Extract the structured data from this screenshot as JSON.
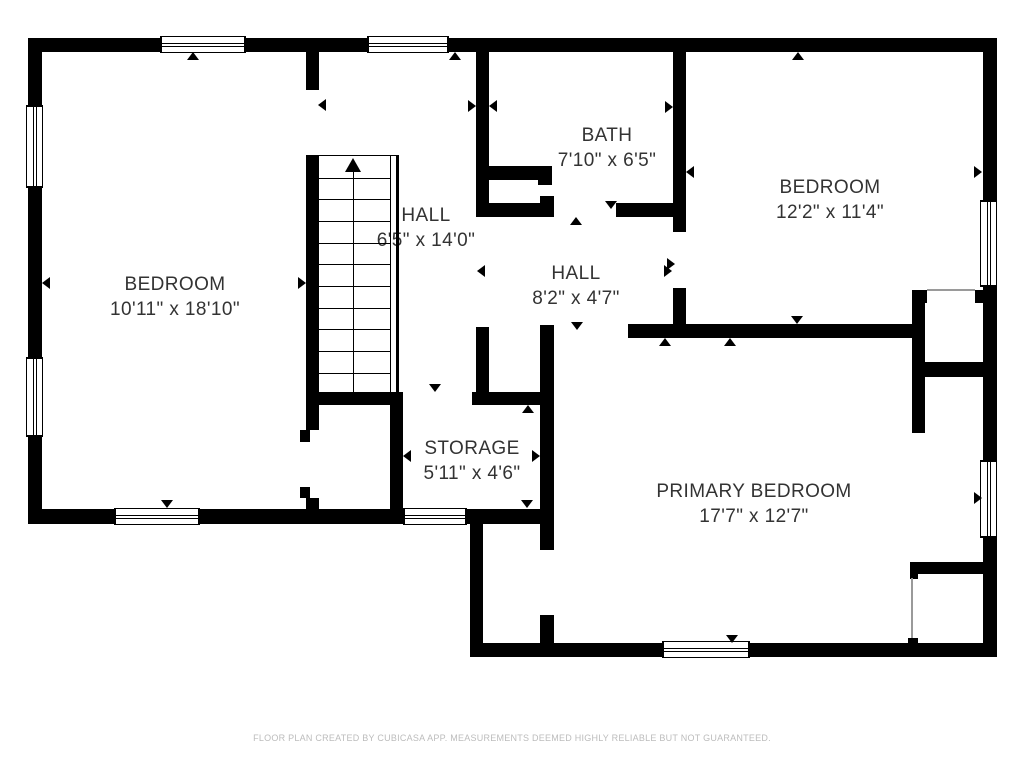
{
  "colors": {
    "wall": "#000000",
    "label_text": "#333333",
    "footer_text": "#bcbcbc",
    "background": "#ffffff"
  },
  "rooms": [
    {
      "id": "bedroom-left",
      "name": "BEDROOM",
      "dims": "10'11\" x 18'10\"",
      "cx": 175,
      "cy": 297
    },
    {
      "id": "hall-stairs",
      "name": "HALL",
      "dims": "6'5\" x 14'0\"",
      "cx": 426,
      "cy": 228
    },
    {
      "id": "bath",
      "name": "BATH",
      "dims": "7'10\" x 6'5\"",
      "cx": 607,
      "cy": 148
    },
    {
      "id": "bedroom-right",
      "name": "BEDROOM",
      "dims": "12'2\" x 11'4\"",
      "cx": 830,
      "cy": 200
    },
    {
      "id": "hall-small",
      "name": "HALL",
      "dims": "8'2\" x 4'7\"",
      "cx": 576,
      "cy": 286
    },
    {
      "id": "storage",
      "name": "STORAGE",
      "dims": "5'11\" x 4'6\"",
      "cx": 472,
      "cy": 461
    },
    {
      "id": "primary-bedroom",
      "name": "PRIMARY BEDROOM",
      "dims": "17'7\" x 12'7\"",
      "cx": 754,
      "cy": 504
    }
  ],
  "footer": {
    "text": "FLOOR PLAN CREATED BY CUBICASA APP. MEASUREMENTS DEEMED HIGHLY RELIABLE BUT NOT GUARANTEED."
  },
  "geometry": {
    "walls": [
      [
        28,
        38,
        969,
        14
      ],
      [
        28,
        38,
        14,
        486
      ],
      [
        28,
        509,
        519,
        15
      ],
      [
        470,
        509,
        13,
        148
      ],
      [
        470,
        643,
        527,
        14
      ],
      [
        983,
        38,
        14,
        619
      ],
      [
        306,
        52,
        13,
        38
      ],
      [
        306,
        155,
        13,
        275
      ],
      [
        300,
        430,
        10,
        12
      ],
      [
        300,
        487,
        10,
        11
      ],
      [
        306,
        498,
        13,
        13
      ],
      [
        306,
        392,
        96,
        13
      ],
      [
        390,
        392,
        13,
        119
      ],
      [
        476,
        52,
        13,
        165
      ],
      [
        489,
        166,
        63,
        14
      ],
      [
        538,
        166,
        14,
        19
      ],
      [
        476,
        203,
        78,
        14
      ],
      [
        540,
        196,
        14,
        21
      ],
      [
        616,
        203,
        70,
        14
      ],
      [
        673,
        52,
        13,
        180
      ],
      [
        673,
        288,
        13,
        48
      ],
      [
        628,
        324,
        292,
        14
      ],
      [
        476,
        327,
        13,
        78
      ],
      [
        472,
        392,
        81,
        13
      ],
      [
        540,
        325,
        14,
        225
      ],
      [
        540,
        615,
        14,
        30
      ],
      [
        912,
        290,
        13,
        143
      ],
      [
        912,
        290,
        15,
        13
      ],
      [
        975,
        290,
        9,
        13
      ],
      [
        920,
        362,
        64,
        15
      ],
      [
        910,
        562,
        74,
        12
      ],
      [
        910,
        574,
        8,
        5
      ],
      [
        908,
        638,
        10,
        6
      ]
    ],
    "thresholds": [
      [
        927,
        289,
        48,
        2
      ],
      [
        911,
        578,
        2,
        60
      ]
    ],
    "windows": [
      {
        "x": 160,
        "y": 36,
        "w": 86,
        "h": 17,
        "o": "h"
      },
      {
        "x": 367,
        "y": 36,
        "w": 82,
        "h": 17,
        "o": "h"
      },
      {
        "x": 26,
        "y": 105,
        "w": 17,
        "h": 83,
        "o": "v"
      },
      {
        "x": 26,
        "y": 357,
        "w": 17,
        "h": 80,
        "o": "v"
      },
      {
        "x": 114,
        "y": 508,
        "w": 86,
        "h": 17,
        "o": "h"
      },
      {
        "x": 403,
        "y": 508,
        "w": 64,
        "h": 17,
        "o": "h"
      },
      {
        "x": 980,
        "y": 200,
        "w": 17,
        "h": 87,
        "o": "v"
      },
      {
        "x": 980,
        "y": 460,
        "w": 17,
        "h": 78,
        "o": "v"
      },
      {
        "x": 662,
        "y": 641,
        "w": 88,
        "h": 17,
        "o": "h"
      }
    ],
    "stairs": {
      "x": 319,
      "y": 155,
      "w": 80,
      "h": 237,
      "step_right": 70.5,
      "steps": [
        21.7,
        43.3,
        65,
        86.7,
        108.3,
        130,
        151.7,
        173.3,
        195,
        216.7
      ],
      "rail1": {
        "left": 70.5,
        "w": 1.5
      },
      "rail2": {
        "left": 76.5,
        "w": 3.5
      },
      "center_line": {
        "left": 33.5,
        "w": 1.5,
        "top": 14
      },
      "up_arrow": {
        "tip_left": 34,
        "half": 8,
        "len": 14
      }
    },
    "arrows": [
      {
        "x": 193,
        "y": 52,
        "d": "up"
      },
      {
        "x": 455,
        "y": 52,
        "d": "up"
      },
      {
        "x": 798,
        "y": 52,
        "d": "up"
      },
      {
        "x": 42,
        "y": 283,
        "d": "left"
      },
      {
        "x": 306,
        "y": 283,
        "d": "right"
      },
      {
        "x": 318,
        "y": 105,
        "d": "left"
      },
      {
        "x": 476,
        "y": 106,
        "d": "right"
      },
      {
        "x": 489,
        "y": 106,
        "d": "left"
      },
      {
        "x": 477,
        "y": 271,
        "d": "left"
      },
      {
        "x": 672,
        "y": 271,
        "d": "right"
      },
      {
        "x": 576,
        "y": 217,
        "d": "up"
      },
      {
        "x": 611,
        "y": 209,
        "d": "down"
      },
      {
        "x": 673,
        "y": 107,
        "d": "right"
      },
      {
        "x": 686,
        "y": 172,
        "d": "left"
      },
      {
        "x": 675,
        "y": 264,
        "d": "right"
      },
      {
        "x": 797,
        "y": 324,
        "d": "down"
      },
      {
        "x": 730,
        "y": 338,
        "d": "up"
      },
      {
        "x": 982,
        "y": 172,
        "d": "right"
      },
      {
        "x": 982,
        "y": 498,
        "d": "right"
      },
      {
        "x": 435,
        "y": 392,
        "d": "down"
      },
      {
        "x": 528,
        "y": 405,
        "d": "up"
      },
      {
        "x": 527,
        "y": 508,
        "d": "down"
      },
      {
        "x": 403,
        "y": 456,
        "d": "left"
      },
      {
        "x": 540,
        "y": 456,
        "d": "right"
      },
      {
        "x": 554,
        "y": 497,
        "d": "right"
      },
      {
        "x": 732,
        "y": 643,
        "d": "down"
      },
      {
        "x": 167,
        "y": 508,
        "d": "down"
      },
      {
        "x": 577,
        "y": 330,
        "d": "down"
      },
      {
        "x": 665,
        "y": 338,
        "d": "up"
      }
    ]
  }
}
